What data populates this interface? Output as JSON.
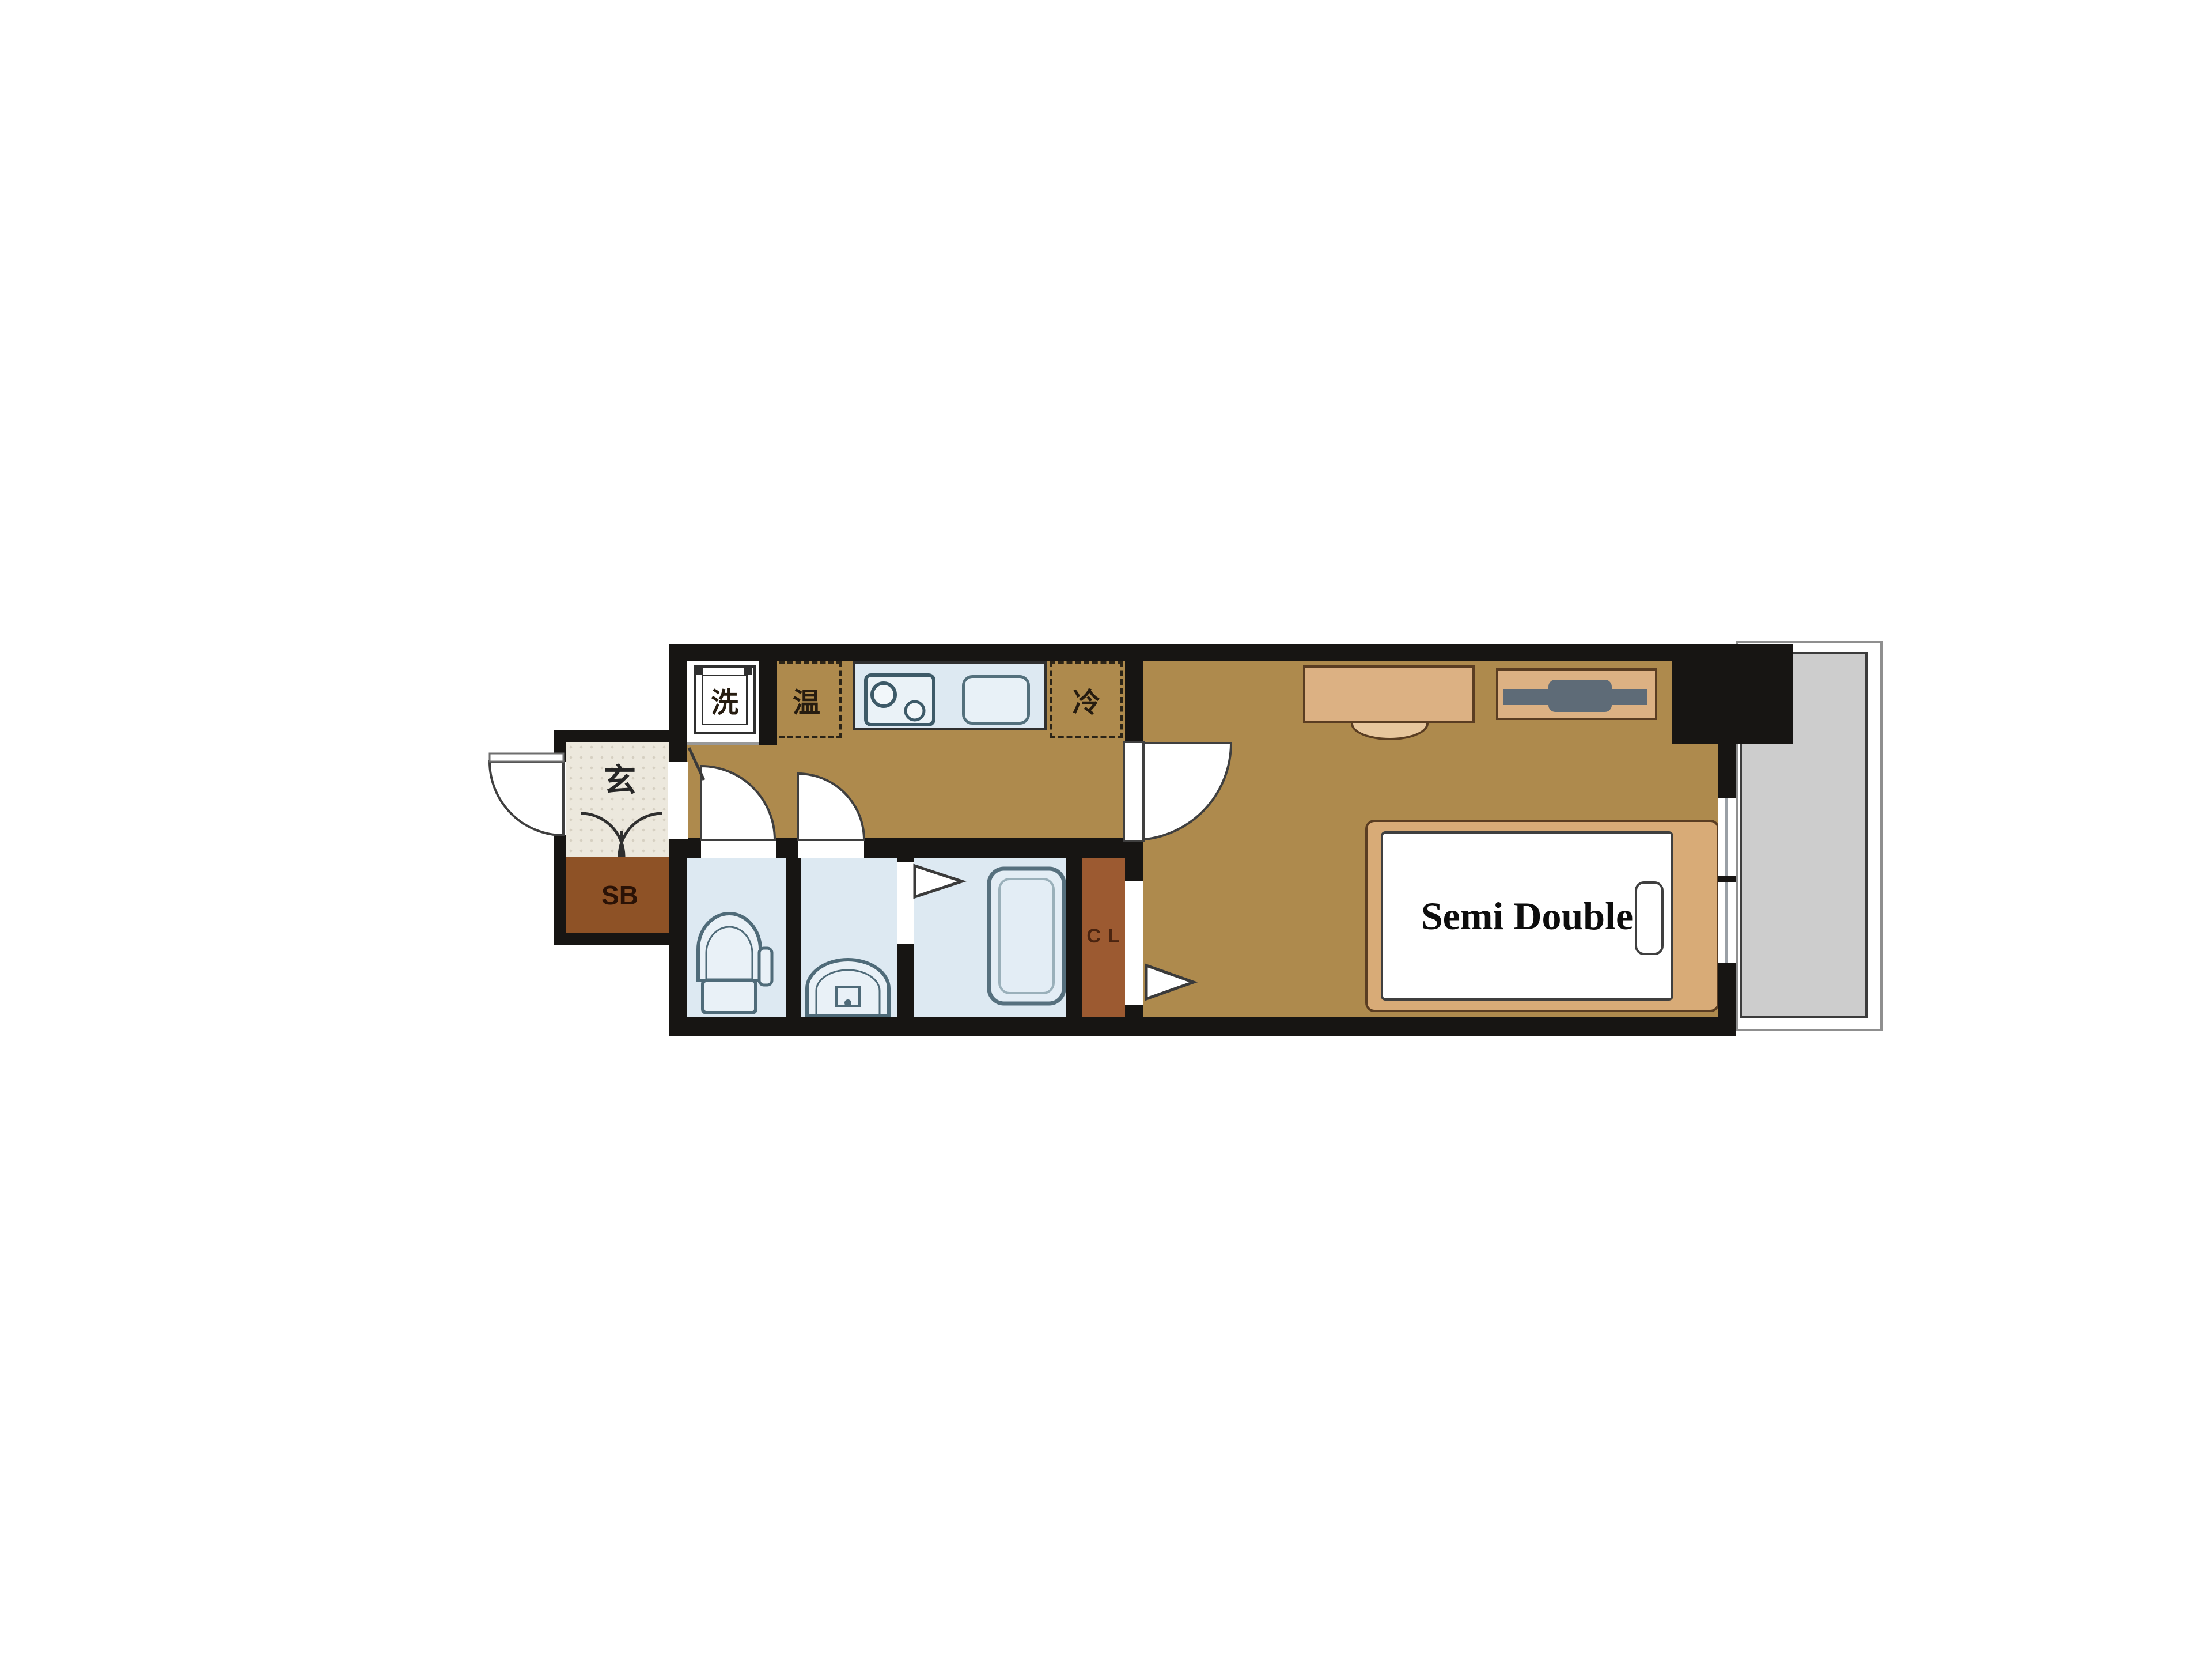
{
  "labels": {
    "entrance": "玄",
    "shoe_box": "SB",
    "washing_machine": "洗",
    "water_heater": "温",
    "refrigerator": "冷",
    "closet": "CL",
    "bed_size": "Semi Double"
  },
  "fixtures": [
    "washing-machine-pan",
    "water-heater-box",
    "refrigerator-box",
    "stove",
    "sink",
    "toilet",
    "washbasin",
    "bathtub",
    "shoe-cabinet-doors",
    "bed",
    "pillow",
    "desk",
    "chair",
    "tv-board",
    "tv",
    "door-swing",
    "sliding-door-arrow",
    "window",
    "balcony",
    "pillar"
  ],
  "colors": {
    "wall": "#171513",
    "floor": "#ae8a4d",
    "wet": "#dde9f2",
    "fixture": "#4f6b79",
    "genkan": "#ece8dd",
    "shoe_box": "#8e5226",
    "closet": "#9c5a31",
    "furniture": "#d8ab77",
    "furniture_line": "#5a3d22",
    "tv": "#5e6b77",
    "balcony": "#cdcdcd",
    "door_line": "#3f3f3f",
    "label": "#261c10"
  }
}
